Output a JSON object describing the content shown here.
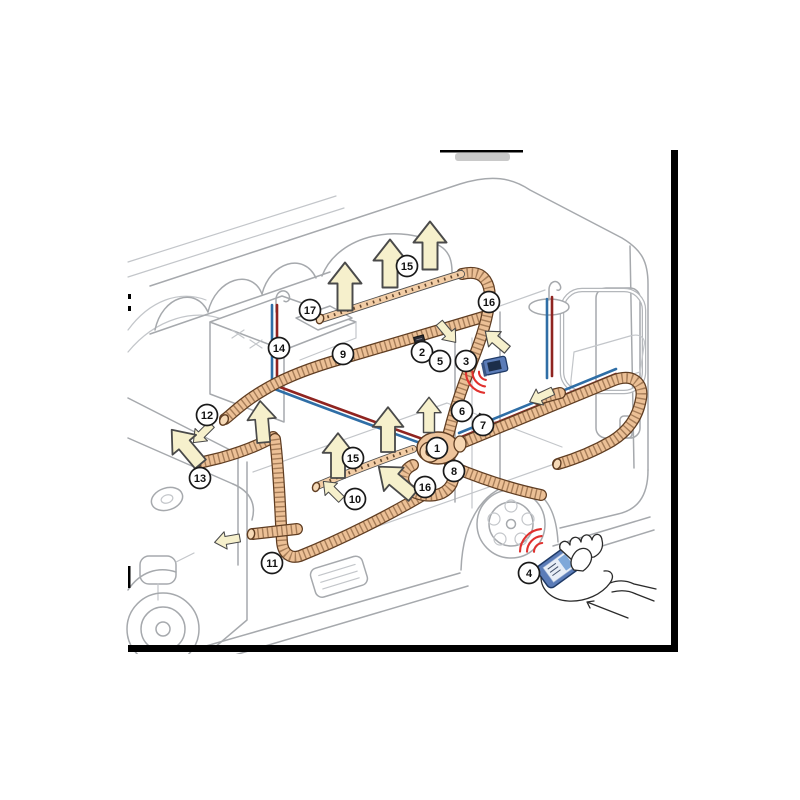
{
  "figure": {
    "kind": "cutaway-technical-illustration",
    "background": "#ffffff"
  },
  "palette": {
    "outline_gray": "#a6a9ad",
    "duct_tan": "#ecc096",
    "duct_shadow_brown": "#5f3d22",
    "arrow_cream": "#f6f0cc",
    "pipe_red": "#8f2420",
    "pipe_blue": "#2f6ea6",
    "panel_blue": "#5b7cb8",
    "signal_red": "#e0312e",
    "frame_black": "#000000"
  },
  "callouts": [
    {
      "label": "1",
      "part": "heater-unit",
      "x": 437,
      "y": 448
    },
    {
      "label": "2",
      "part": "wall-mounted-module",
      "x": 422,
      "y": 352
    },
    {
      "label": "3",
      "part": "wall-control-panel",
      "x": 466,
      "y": 361
    },
    {
      "label": "4",
      "part": "smartphone-remote",
      "x": 529,
      "y": 573
    },
    {
      "label": "5",
      "part": "wall-sensor",
      "x": 440,
      "y": 361
    },
    {
      "label": "6",
      "part": "connection-point",
      "x": 462,
      "y": 411
    },
    {
      "label": "7",
      "part": "wall-bracket",
      "x": 483,
      "y": 425
    },
    {
      "label": "8",
      "part": "drain-valve",
      "x": 454,
      "y": 471
    },
    {
      "label": "9",
      "part": "air-duct",
      "x": 343,
      "y": 354
    },
    {
      "label": "10",
      "part": "air-duct",
      "x": 355,
      "y": 499
    },
    {
      "label": "11",
      "part": "air-duct",
      "x": 272,
      "y": 563
    },
    {
      "label": "12",
      "part": "air-outlet",
      "x": 207,
      "y": 415
    },
    {
      "label": "13",
      "part": "air-duct-end",
      "x": 200,
      "y": 478
    },
    {
      "label": "14",
      "part": "water-lines-sink",
      "x": 279,
      "y": 348
    },
    {
      "label": "15",
      "part": "vent-rail",
      "x": 407,
      "y": 266
    },
    {
      "label": "15",
      "part": "vent-rail",
      "x": 353,
      "y": 458
    },
    {
      "label": "16",
      "part": "duct-bend",
      "x": 489,
      "y": 302
    },
    {
      "label": "16",
      "part": "duct-bend",
      "x": 425,
      "y": 487
    },
    {
      "label": "17",
      "part": "duct-end-cap",
      "x": 310,
      "y": 310
    }
  ],
  "airflow_arrows": [
    {
      "x": 345,
      "y": 288,
      "angle": 0,
      "scale": 1.5
    },
    {
      "x": 390,
      "y": 265,
      "angle": 0,
      "scale": 1.5
    },
    {
      "x": 430,
      "y": 247,
      "angle": 0,
      "scale": 1.5
    },
    {
      "x": 447,
      "y": 332,
      "angle": 140,
      "scale": 0.8
    },
    {
      "x": 497,
      "y": 341,
      "angle": -50,
      "scale": 0.9
    },
    {
      "x": 542,
      "y": 396,
      "angle": -115,
      "scale": 0.8
    },
    {
      "x": 203,
      "y": 433,
      "angle": -135,
      "scale": 0.8
    },
    {
      "x": 187,
      "y": 448,
      "angle": -40,
      "scale": 1.4
    },
    {
      "x": 262,
      "y": 423,
      "angle": -5,
      "scale": 1.3
    },
    {
      "x": 228,
      "y": 540,
      "angle": -100,
      "scale": 0.8
    },
    {
      "x": 333,
      "y": 491,
      "angle": -45,
      "scale": 0.8
    },
    {
      "x": 338,
      "y": 457,
      "angle": 0,
      "scale": 1.4
    },
    {
      "x": 388,
      "y": 431,
      "angle": 0,
      "scale": 1.4
    },
    {
      "x": 429,
      "y": 416,
      "angle": 0,
      "scale": 1.1
    },
    {
      "x": 397,
      "y": 482,
      "angle": -50,
      "scale": 1.4
    }
  ],
  "wifi_signals": [
    {
      "name": "panel-signal",
      "x": 487,
      "y": 372,
      "dir": 140,
      "radii": [
        8,
        14.5,
        21
      ]
    },
    {
      "name": "phone-signal",
      "x": 543,
      "y": 552,
      "dir": -137,
      "radii": [
        9,
        16,
        23
      ]
    }
  ]
}
